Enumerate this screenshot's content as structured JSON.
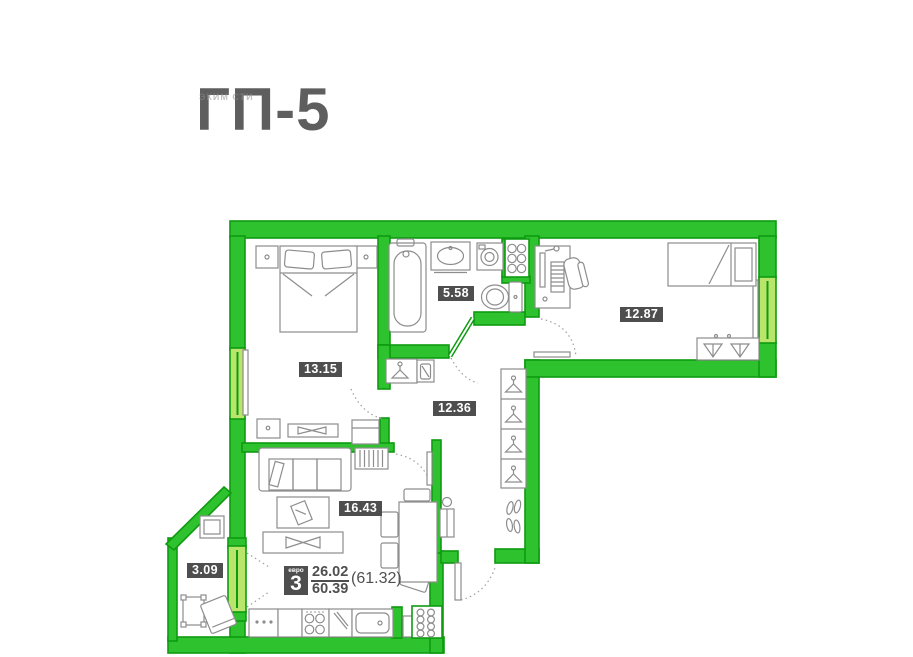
{
  "title": "ГП-5",
  "watermark": "ЭКИМ СТИ",
  "plan": {
    "rooms": [
      {
        "id": "bedroom",
        "area": "13.15"
      },
      {
        "id": "bathroom",
        "area": "5.58"
      },
      {
        "id": "bedroom-2",
        "area": "12.87"
      },
      {
        "id": "hallway",
        "area": "12.36"
      },
      {
        "id": "living-kitchen",
        "area": "16.43"
      },
      {
        "id": "balcony",
        "area": "3.09"
      }
    ],
    "legend": {
      "layout_type": "евро",
      "rooms_count": "3",
      "living_area": "26.02",
      "total_area": "60.39",
      "area_with_balcony": "(61.32)"
    },
    "colors": {
      "wall": "#2ec22e",
      "wall_outline": "#0e9b10",
      "window": "#b9e56b",
      "label_bg": "#4e4e4e",
      "label_text": "#ffffff",
      "title_text": "#5e5e5e"
    }
  }
}
